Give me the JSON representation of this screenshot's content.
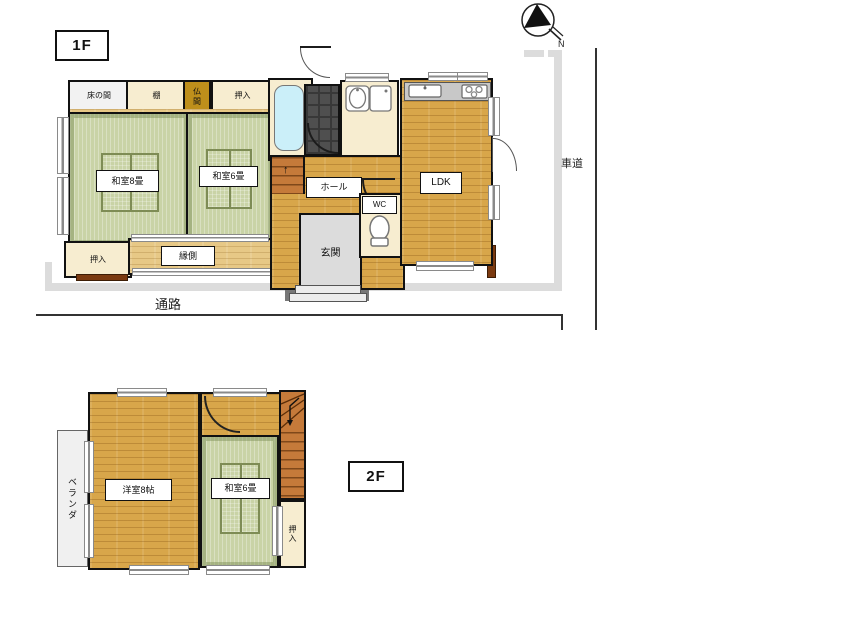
{
  "palette": {
    "tatami_green": "#C9D3A6",
    "wood_tan": "#D8A64A",
    "wood_light": "#E7C886",
    "closet_cream": "#F7EDD0",
    "butsuma_gold": "#BE8F1B",
    "bath_tile_dark": "#4F4F4F",
    "tub_blue": "#CBEFF9",
    "genkan_gray": "#DCDCDC",
    "boundary_gray": "#DCDCDC",
    "stairs_brown": "#C57A3A",
    "accent_brown": "#7B3A10"
  },
  "compass": {
    "north": "N"
  },
  "floor1": {
    "label": "1F",
    "rooms": {
      "tokonoma": "床の間",
      "tana": "棚",
      "butsuma": "仏間",
      "oshiire_top": "押入",
      "washitsu8": "和室8畳",
      "washitsu6": "和室6畳",
      "oshiire_left": "押入",
      "engawa": "縁側",
      "hall": "ホール",
      "ldk": "LDK",
      "genkan": "玄関",
      "wc": "WC"
    },
    "stairs_up_arrow": "↑",
    "outside": {
      "passage": "通路",
      "road": "車道"
    }
  },
  "floor2": {
    "label": "2F",
    "rooms": {
      "veranda": "ベランダ",
      "yoshitsu8": "洋室8帖",
      "washitsu6": "和室6畳",
      "oshiire": "押入"
    },
    "stairs_down_arrow": "↓"
  }
}
